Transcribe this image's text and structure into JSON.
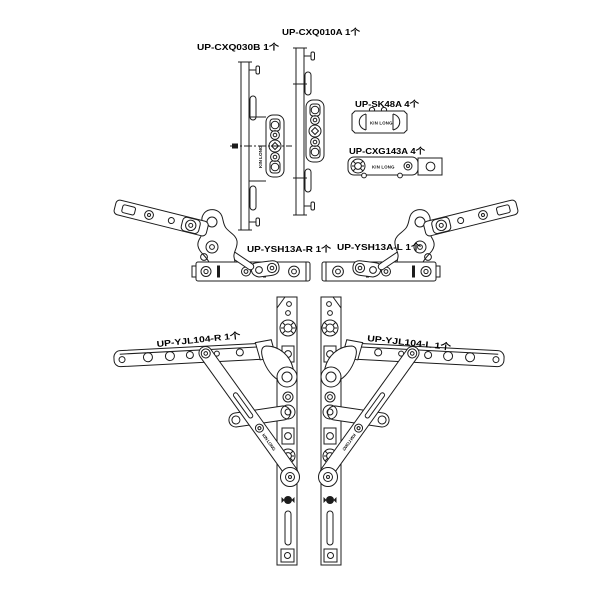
{
  "drawing": {
    "background_color": "#ffffff",
    "line_color": "#1c1c1c",
    "brand_text": "KIN LONG",
    "parts": [
      {
        "id": "cxq030b",
        "label": "UP-CXQ030B 1个"
      },
      {
        "id": "cxq010a",
        "label": "UP-CXQ010A 1个"
      },
      {
        "id": "sk48a",
        "label": "UP-SK48A 4个"
      },
      {
        "id": "cxg143a",
        "label": "UP-CXG143A 4个"
      },
      {
        "id": "ysh13a-r",
        "label": "UP-YSH13A-R 1个"
      },
      {
        "id": "ysh13a-l",
        "label": "UP-YSH13A-L 1个"
      },
      {
        "id": "yjl104-r",
        "label": "UP-YJL104-R 1个"
      },
      {
        "id": "yjl104-l",
        "label": "UP-YJL104-L 1个"
      }
    ]
  }
}
